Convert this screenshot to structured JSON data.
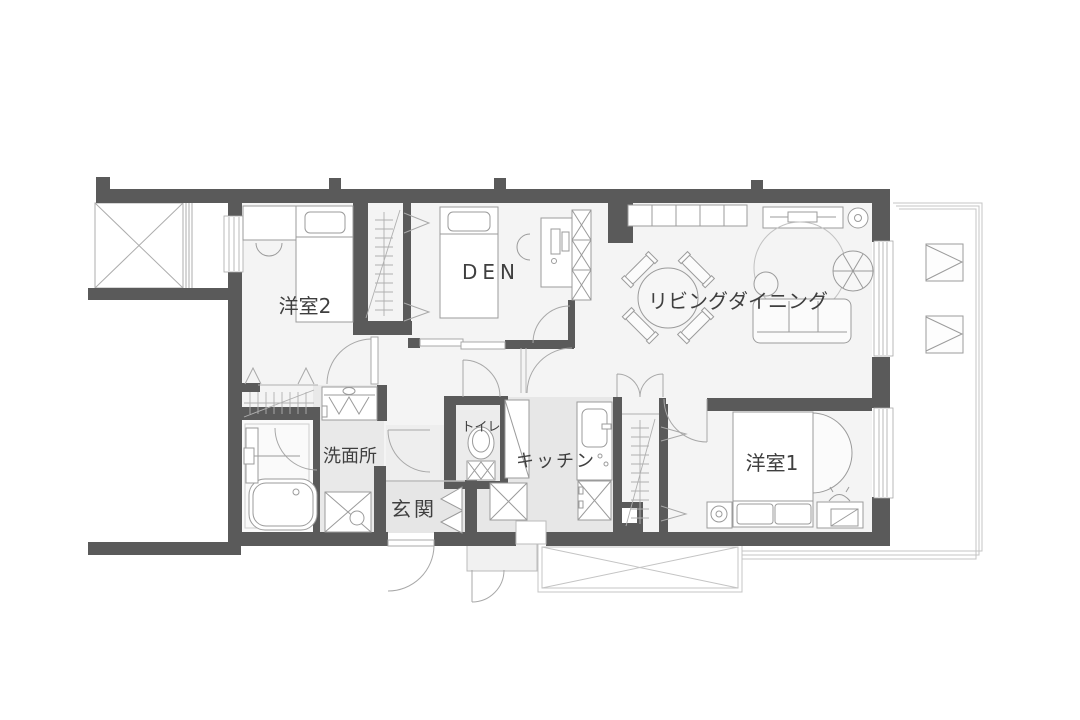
{
  "rooms": [
    {
      "name": "洋室2"
    },
    {
      "name": "DEN"
    },
    {
      "name": "リビングダイニング"
    },
    {
      "name": "洋室1"
    },
    {
      "name": "トイレ"
    },
    {
      "name": "キッチン"
    },
    {
      "name": "洗面所"
    },
    {
      "name": "玄関"
    }
  ],
  "colors": {
    "wall": "#5a5a5a",
    "floor": "#f4f4f4",
    "wet_floor": "#e7e7e7",
    "hall_floor": "#ededed",
    "bath_floor": "#fafafa",
    "furniture_line": "#9b9b9b",
    "thin_line": "#b9b9b9",
    "balcony_line": "#c4c4c4",
    "text": "#3f3f3f"
  }
}
